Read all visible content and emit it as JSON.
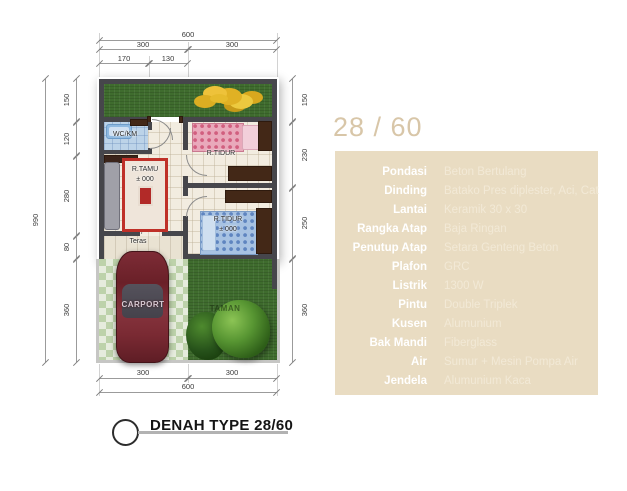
{
  "plan": {
    "dims": {
      "top_total": "600",
      "top_left": "300",
      "top_right": "300",
      "sub_left": "170",
      "sub_right": "130",
      "left_total": "990",
      "left_1": "150",
      "left_2": "120",
      "left_3": "280",
      "left_4": "80",
      "left_5": "360",
      "right_1": "150",
      "right_2": "230",
      "right_3": "250",
      "right_4": "360",
      "bottom_left": "300",
      "bottom_right": "300",
      "bottom_total": "600"
    },
    "rooms": {
      "wc": "WC/KM",
      "bedroom1": "R.TIDUR",
      "living": "R.TAMU",
      "living_level": "± 000",
      "bedroom2": "R.TIDUR",
      "bedroom2_level": "± 000",
      "teras": "Teras",
      "carport": "CARPORT",
      "garden": "TAMAN"
    },
    "footer_label": "DENAH TYPE 28/60"
  },
  "specs": {
    "title": "28 / 60",
    "rows": [
      {
        "label": "Pondasi",
        "value": "Beton Bertulang"
      },
      {
        "label": "Dinding",
        "value": "Batako Pres diplester, Aci, Cat"
      },
      {
        "label": "Lantai",
        "value": "Keramik 30 x 30"
      },
      {
        "label": "Rangka Atap",
        "value": "Baja Ringan"
      },
      {
        "label": "Penutup Atap",
        "value": "Setara Genteng Beton"
      },
      {
        "label": "Plafon",
        "value": "GRC"
      },
      {
        "label": "Listrik",
        "value": "1300 W"
      },
      {
        "label": "Pintu",
        "value": "Double Triplek"
      },
      {
        "label": "Kusen",
        "value": "Alumunium"
      },
      {
        "label": "Bak Mandi",
        "value": "Fiberglass"
      },
      {
        "label": "Air",
        "value": "Sumur + Mesin Pompa Air"
      },
      {
        "label": "Jendela",
        "value": "Alumunium Kaca"
      }
    ]
  },
  "colors": {
    "panel_bg": "#e9dcc2",
    "panel_title": "#d8c6a8",
    "spec_label": "#ffffff",
    "spec_value": "#f2e9d6",
    "wall": "#46464b",
    "grass": "#3f6c2e",
    "floor": "#f2ece0",
    "wc_floor": "#bcd3e8",
    "car_body": "#6f2630",
    "carpet_border": "#bf3028"
  }
}
